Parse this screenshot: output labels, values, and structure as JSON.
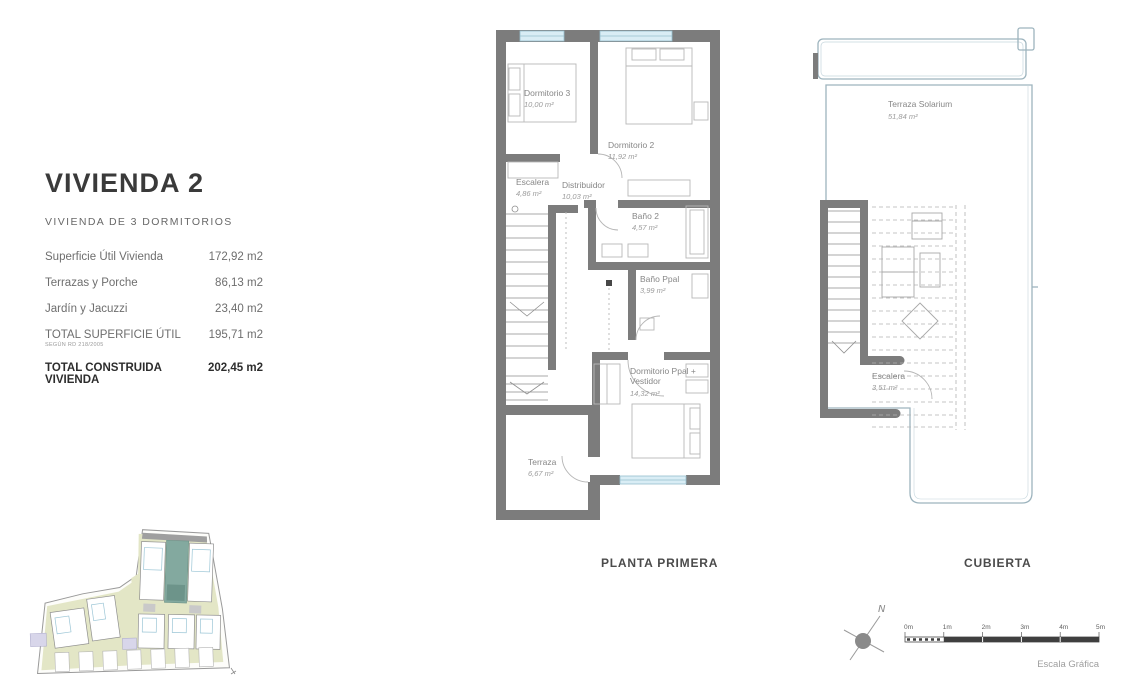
{
  "info_panel": {
    "title": "VIVIENDA 2",
    "subtitle": "VIVIENDA DE 3 DORMITORIOS",
    "rows": [
      {
        "label": "Superficie Útil Vivienda",
        "value": "172,92 m2"
      },
      {
        "label": "Terrazas y Porche",
        "value": "86,13 m2"
      },
      {
        "label": "Jardín y Jacuzzi",
        "value": "23,40 m2"
      },
      {
        "label": "TOTAL SUPERFICIE ÚTIL",
        "note": "SEGÚN RD 218/2005",
        "value": "195,71 m2"
      },
      {
        "label": "TOTAL CONSTRUIDA VIVIENDA",
        "value": "202,45 m2"
      }
    ]
  },
  "planta_primera": {
    "caption": "PLANTA PRIMERA",
    "rooms": {
      "dormitorio_3": {
        "name": "Dormitorio 3",
        "area": "10,00 m²"
      },
      "dormitorio_2": {
        "name": "Dormitorio 2",
        "area": "11,92 m²"
      },
      "escalera": {
        "name": "Escalera",
        "area": "4,86 m²"
      },
      "distribuidor": {
        "name": "Distribuidor",
        "area": "10,03 m²"
      },
      "bano_2": {
        "name": "Baño 2",
        "area": "4,57 m²"
      },
      "bano_ppal": {
        "name": "Baño Ppal",
        "area": "3,99 m²"
      },
      "dormitorio_ppal": {
        "name": "Dormitorio Ppal +",
        "name2": "Vestidor",
        "area": "14,32 m²"
      },
      "terraza": {
        "name": "Terraza",
        "area": "6,67 m²"
      }
    }
  },
  "cubierta": {
    "caption": "CUBIERTA",
    "rooms": {
      "terraza_solarium": {
        "name": "Terraza Solarium",
        "area": "51,84 m²"
      },
      "escalera": {
        "name": "Escalera",
        "area": "3,51 m²"
      }
    }
  },
  "compass": {
    "label": "N"
  },
  "scale_bar": {
    "ticks": [
      "0m",
      "1m",
      "2m",
      "3m",
      "4m",
      "5m"
    ],
    "caption": "Escala Gráfica"
  },
  "colors": {
    "wall_gray": "#7c7c7c",
    "window_blue": "#d9edf5",
    "highlight_unit_teal": "#83a99f",
    "site_ground_khaki": "#e3e6c6",
    "label_gray": "#878787"
  }
}
